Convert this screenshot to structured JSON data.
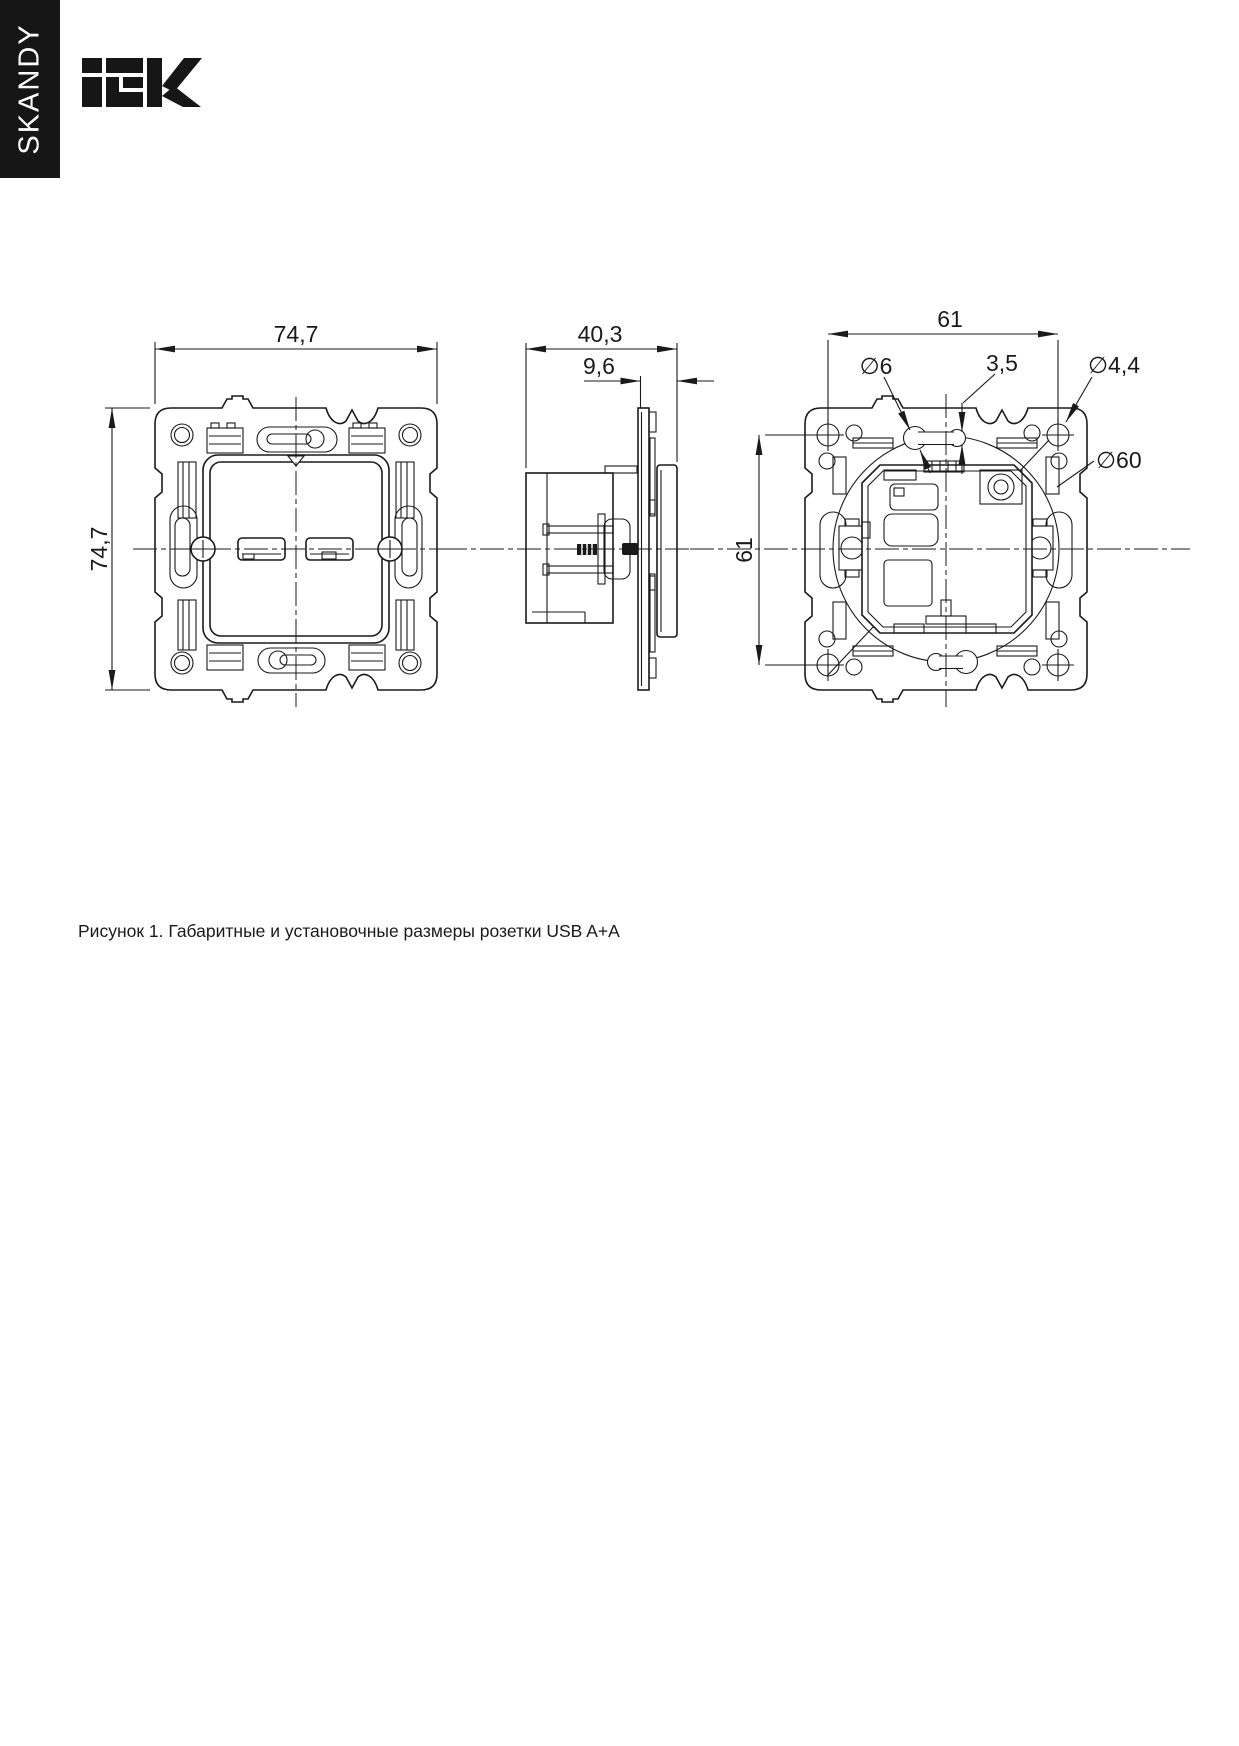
{
  "header": {
    "series": "SKANDY",
    "brand": "IEK"
  },
  "caption": {
    "text": "Рисунок 1. Габаритные и установочные размеры розетки USB A+A"
  },
  "figure": {
    "front": {
      "width_label": "74,7",
      "height_label": "74,7"
    },
    "side": {
      "depth_label": "40,3",
      "protrusion_label": "9,6"
    },
    "rear": {
      "width_label": "61",
      "height_label": "61",
      "slot_hole_label": "∅6",
      "slot_width_label": "3,5",
      "mount_hole_label": "∅4,4",
      "box_diameter_label": "∅60"
    }
  }
}
